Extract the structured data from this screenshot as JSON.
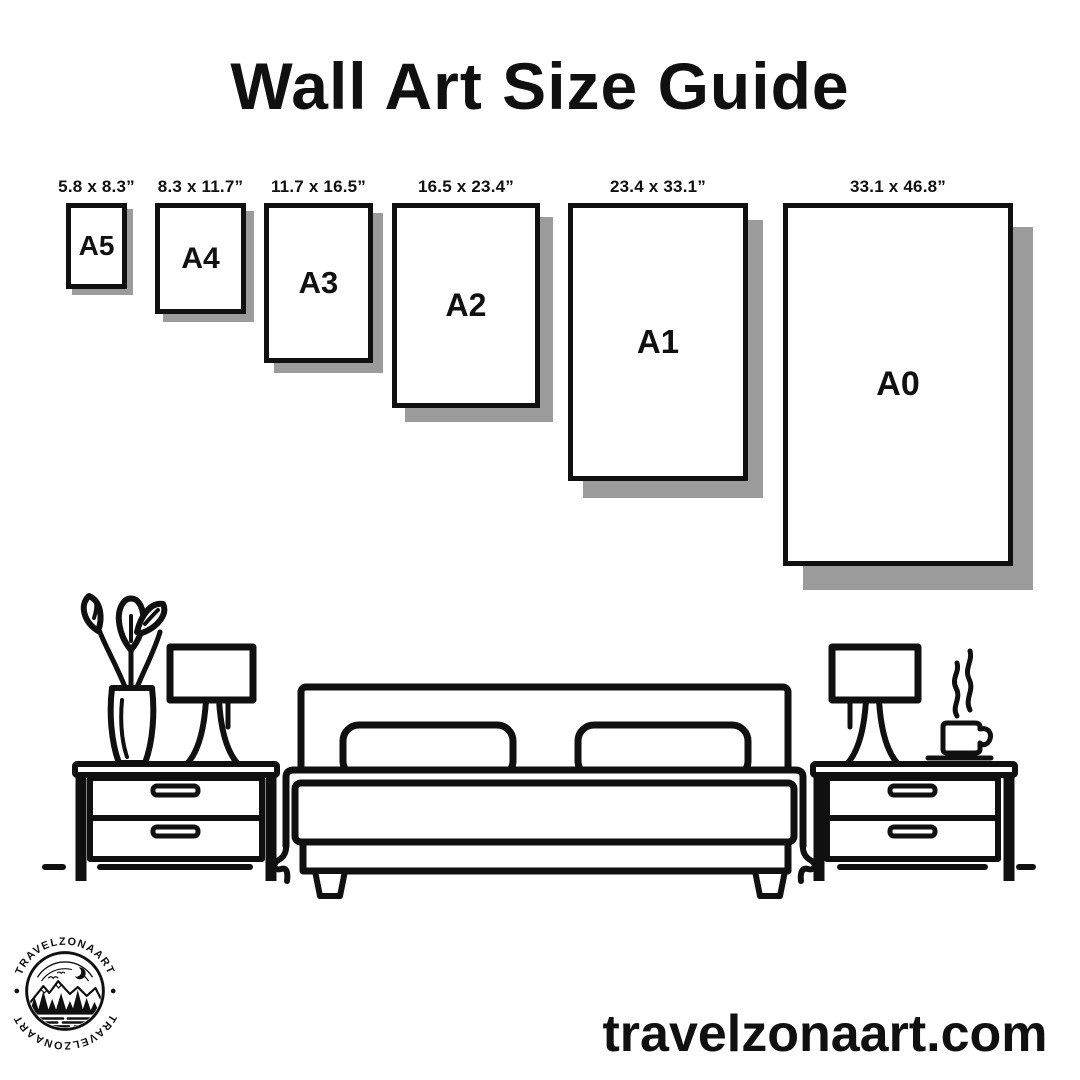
{
  "title": "Wall Art Size Guide",
  "sizes": [
    {
      "label": "A5",
      "dimensions": "5.8 x 8.3”"
    },
    {
      "label": "A4",
      "dimensions": "8.3 x 11.7”"
    },
    {
      "label": "A3",
      "dimensions": "11.7 x 16.5”"
    },
    {
      "label": "A2",
      "dimensions": "16.5 x 23.4”"
    },
    {
      "label": "A1",
      "dimensions": "23.4 x 33.1”"
    },
    {
      "label": "A0",
      "dimensions": "33.1 x 46.8”"
    }
  ],
  "logo": {
    "brand_top": "TRAVELZONAART",
    "brand_bottom": "TRAVELZONAART"
  },
  "footer": {
    "website": "travelzonaart.com"
  },
  "colors": {
    "ink": "#101010",
    "shadow": "#9b9b9b",
    "background": "#ffffff"
  }
}
